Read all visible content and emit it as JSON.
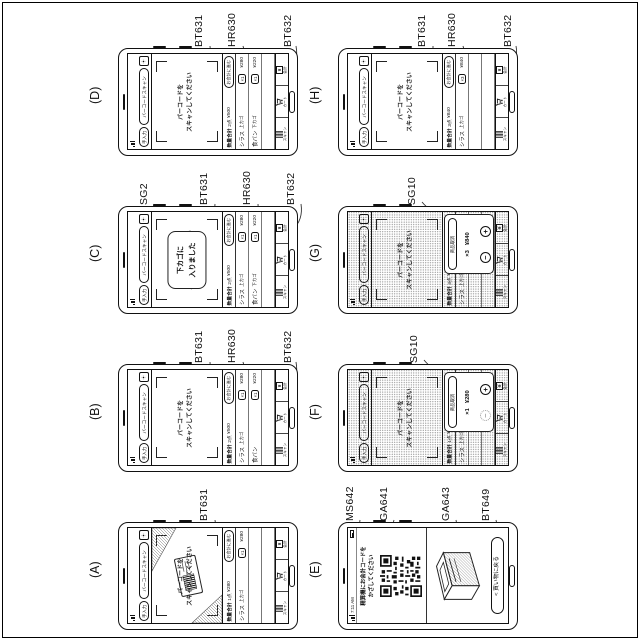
{
  "common": {
    "manual_tab": "手入力",
    "scan_tab": "バーコードスキャン",
    "hint": [
      "バーコードを",
      "スキャンしてください"
    ],
    "summary_label": "数量合計",
    "checkout_button": "お会計に進む",
    "nav": [
      {
        "icon": "barcode-scan-icon",
        "label": "スキャン"
      },
      {
        "icon": "cart-icon",
        "label": "カート"
      },
      {
        "icon": "receipt-icon",
        "label": "会計",
        "glyph": "¥"
      }
    ],
    "line_color": "#333333",
    "ink_color": "#111111"
  },
  "panels": {
    "A": {
      "label": "(A)",
      "callouts": [
        "BT631"
      ],
      "summary": {
        "count": "1点",
        "total": "¥280"
      },
      "items": [
        {
          "name": "シラス",
          "basket": "上カゴ",
          "qty": "×1",
          "price": "¥280"
        }
      ]
    },
    "B": {
      "label": "(B)",
      "callouts": [
        "BT631",
        "HR630",
        "BT632"
      ],
      "summary": {
        "count": "2点",
        "total": "¥500"
      },
      "items": [
        {
          "name": "シラス",
          "basket": "上カゴ",
          "qty": "×1",
          "price": "¥280"
        },
        {
          "name": "食パン",
          "basket": "",
          "qty": "×1",
          "price": "¥220"
        }
      ]
    },
    "C": {
      "label": "(C)",
      "callouts": [
        "SG2",
        "BT631",
        "HR630",
        "BT632"
      ],
      "toast": [
        "下カゴに",
        "入りました"
      ],
      "summary": {
        "count": "2点",
        "total": "¥500"
      },
      "items": [
        {
          "name": "シラス",
          "basket": "上カゴ",
          "qty": "×1",
          "price": "¥280"
        },
        {
          "name": "食パン",
          "basket": "下カゴ",
          "qty": "×1",
          "price": "¥220"
        }
      ]
    },
    "D": {
      "label": "(D)",
      "callouts": [
        "BT631",
        "HR630",
        "BT632"
      ],
      "summary": {
        "count": "2点",
        "total": "¥500"
      },
      "items": [
        {
          "name": "シラス",
          "basket": "上カゴ",
          "qty": "×1",
          "price": "¥280"
        },
        {
          "name": "食パン",
          "basket": "下カゴ",
          "qty": "×1",
          "price": "¥220"
        }
      ]
    },
    "E": {
      "label": "(E)",
      "callouts": [
        "MS642",
        "GA641",
        "GA643",
        "BT649"
      ],
      "status_time": "7:11 AM",
      "message": [
        "精算機にお会計コードを",
        "かざしてください"
      ],
      "back_button": "< 買い物に戻る"
    },
    "F": {
      "label": "(F)",
      "callouts": [
        "SG10"
      ],
      "summary": {
        "count": "1点",
        "total": "¥280"
      },
      "items": [
        {
          "name": "シラス",
          "basket": "上カゴ",
          "qty": "×1",
          "price": "¥280"
        }
      ],
      "dialog": {
        "cancel": "商品取消",
        "qty": "×1",
        "price": "¥280",
        "minus": "−",
        "plus": "+"
      }
    },
    "G": {
      "label": "(G)",
      "callouts": [
        "SG10"
      ],
      "summary": {
        "count": "3点",
        "total": "¥840"
      },
      "items": [
        {
          "name": "シラス",
          "basket": "上カゴ",
          "qty": "×3",
          "price": "¥840"
        }
      ],
      "dialog": {
        "cancel": "商品取消",
        "qty": "×3",
        "price": "¥840",
        "minus": "−",
        "plus": "+"
      }
    },
    "H": {
      "label": "(H)",
      "callouts": [
        "BT631",
        "HR630",
        "BT632"
      ],
      "summary": {
        "count": "3点",
        "total": "¥840"
      },
      "items": [
        {
          "name": "シラス",
          "basket": "上カゴ",
          "qty": "×3",
          "price": "¥840"
        }
      ]
    }
  }
}
